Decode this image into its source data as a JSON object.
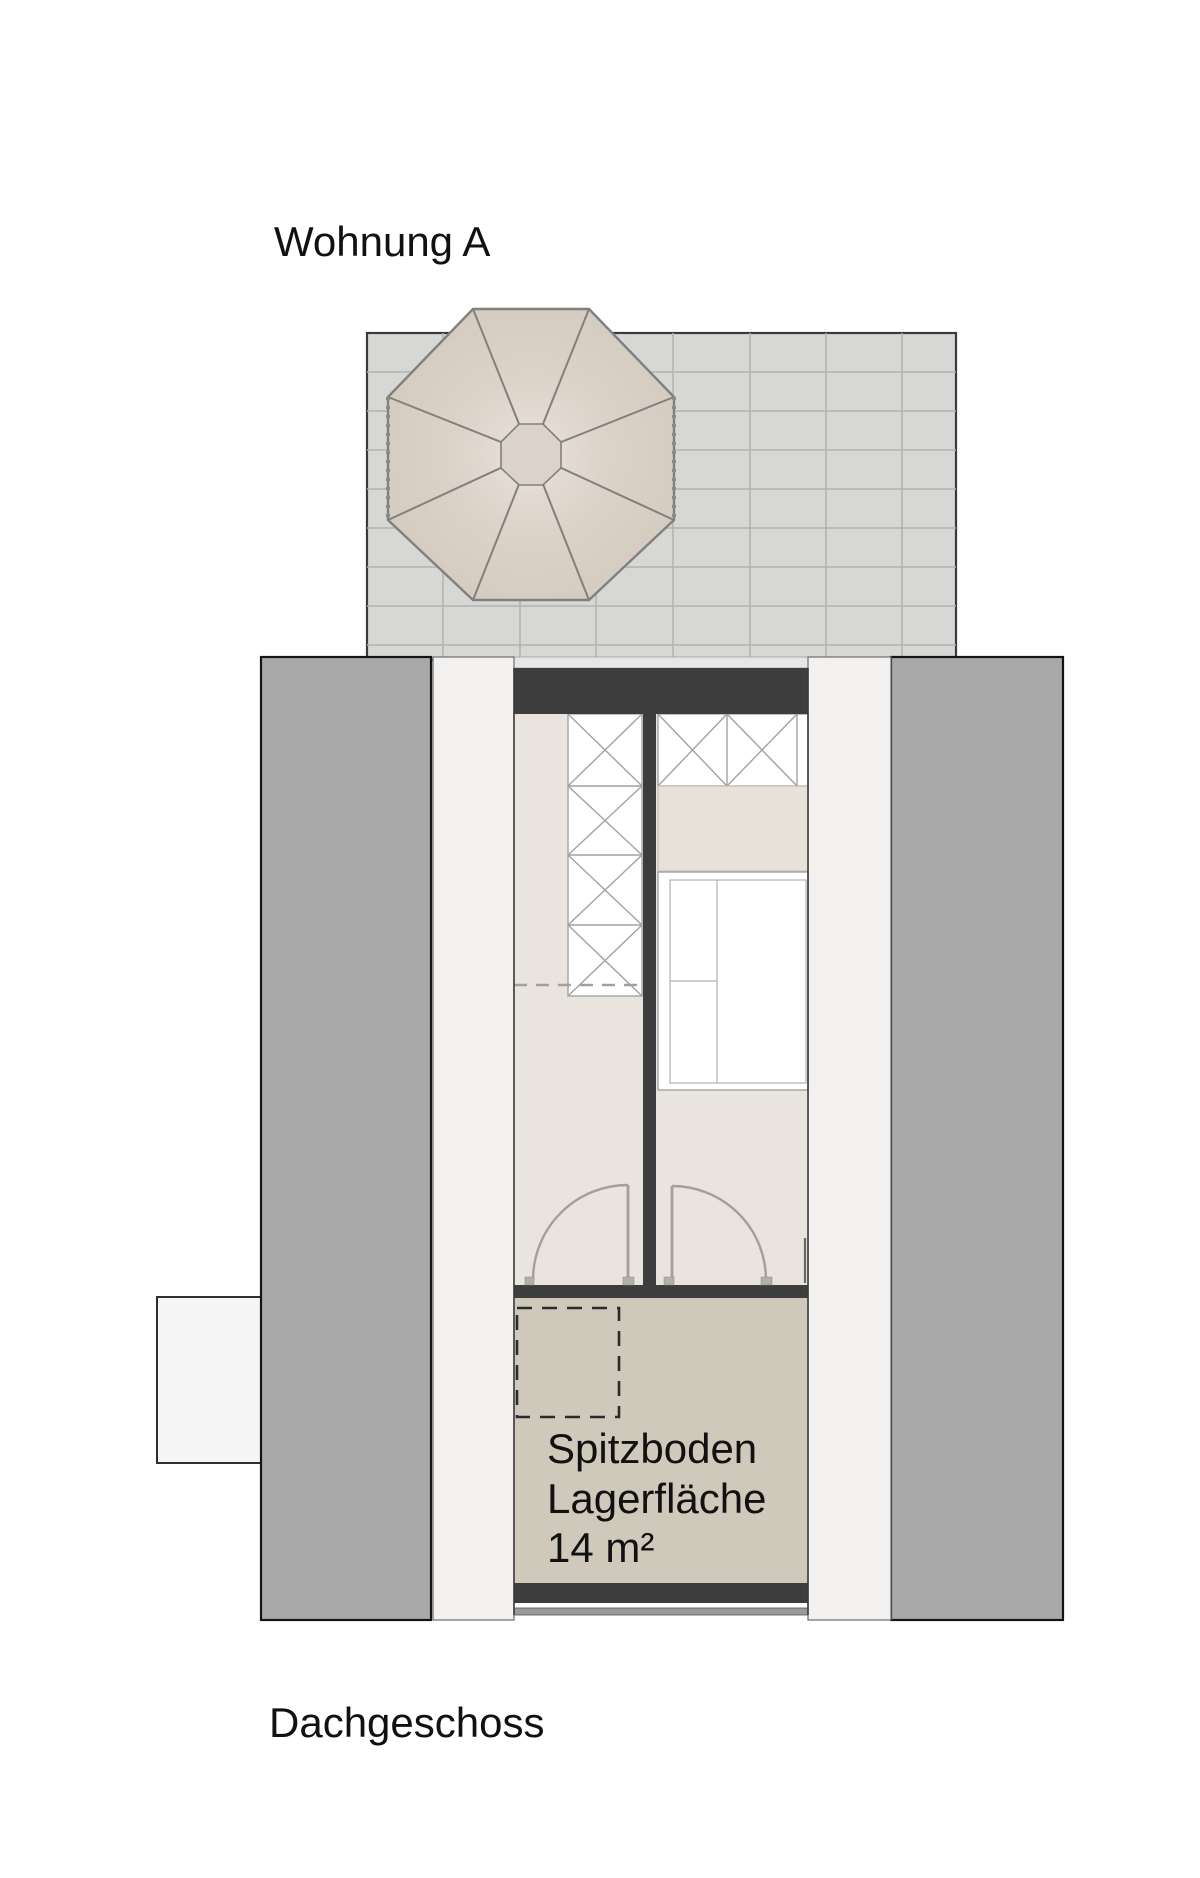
{
  "page": {
    "apartment_title": "Wohnung A",
    "floor_title": "Dachgeschoss"
  },
  "plan": {
    "attic_storage_label": {
      "line1": "Spitzboden",
      "line2": "Lagerfläche",
      "line3": "14 m²"
    }
  },
  "colors": {
    "wall_dark": "#3d3d3d",
    "roof_slab_gray": "#a9a9a9",
    "terrace_tile": "#d7d7d6",
    "terrace_grid_line": "#b2b2b0",
    "parasol_beige": "#d5ccc2",
    "parasol_line": "#82807d",
    "room_floor_beige": "#e9e5de",
    "attic_floor_tan": "#cfc9bc",
    "outer_strip_white": "#f2f1ef",
    "dormer_white": "#f5f5f5",
    "furniture_line_gray": "#a2a2a0",
    "door_line_gray": "#a39f99",
    "eaves_line_gray": "#9a9a9a"
  }
}
